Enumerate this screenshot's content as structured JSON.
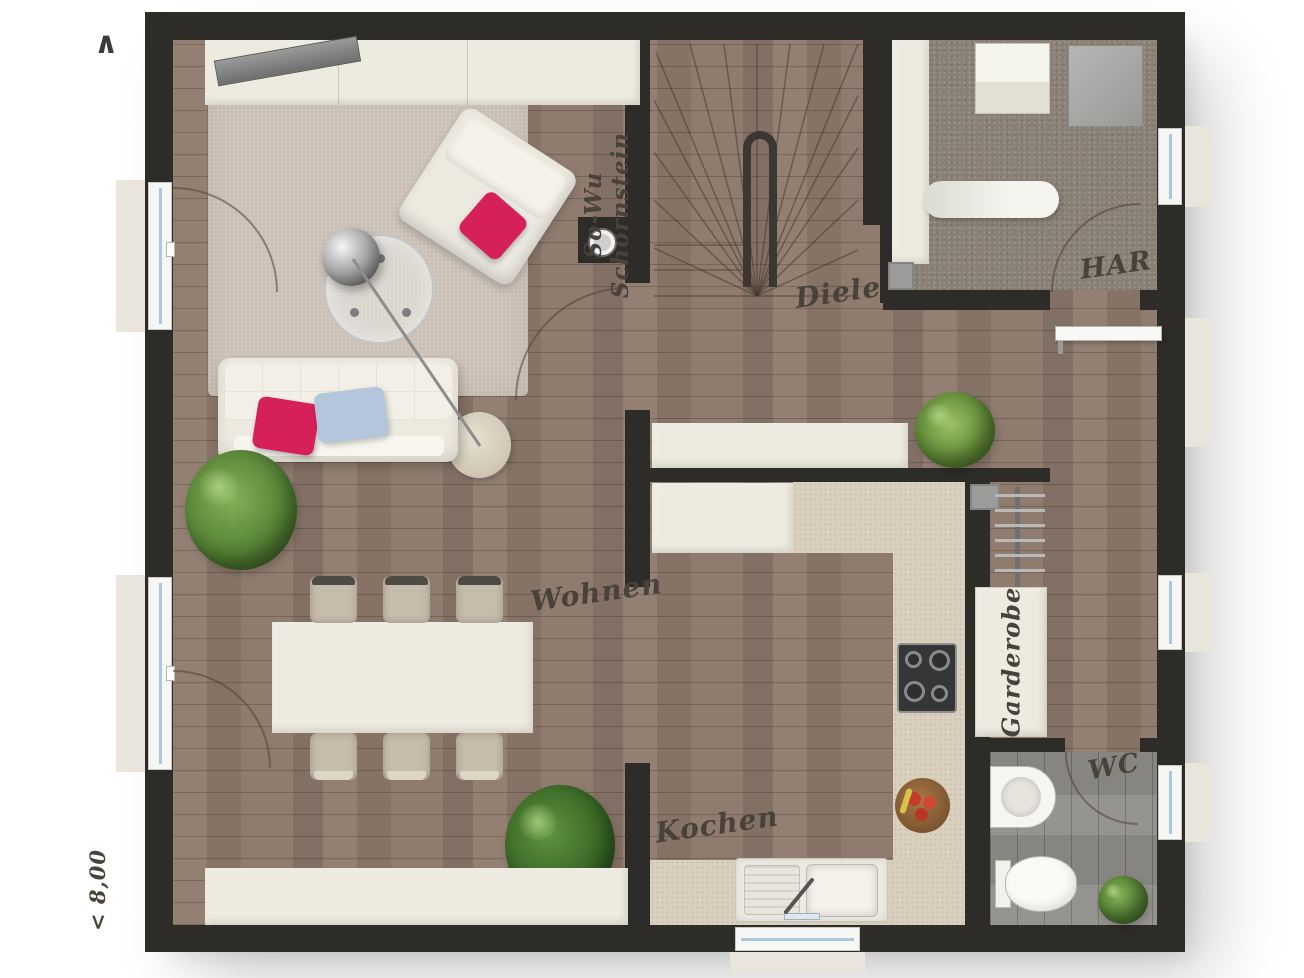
{
  "floorplan": {
    "rooms": {
      "living": {
        "label": "Wohnen"
      },
      "kitchen": {
        "label": "Kochen"
      },
      "hall": {
        "label": "Diele"
      },
      "utility": {
        "label": "HAR"
      },
      "wc": {
        "label": "WC"
      }
    },
    "fixtures": {
      "wardrobe_label": "Garderobe",
      "chimney_line1": "So-Wu",
      "chimney_line2": "Schornstein"
    },
    "annotations": {
      "north_arrow": "∧",
      "width_dimension": "< 8,00"
    },
    "colors": {
      "wall": "#2e2c29",
      "wood_floor": "#8d796c",
      "utility_carpet": "#8a8076",
      "wc_floor": "#8f8d89",
      "counter_beige": "#d9d0be",
      "furniture_cream": "#edebdf",
      "accent_pink": "#d6205a",
      "accent_blue": "#b3c6dc",
      "plant_green": "#537f33",
      "window_glass": "#a9c6e2",
      "label_ink": "#48423a"
    }
  }
}
